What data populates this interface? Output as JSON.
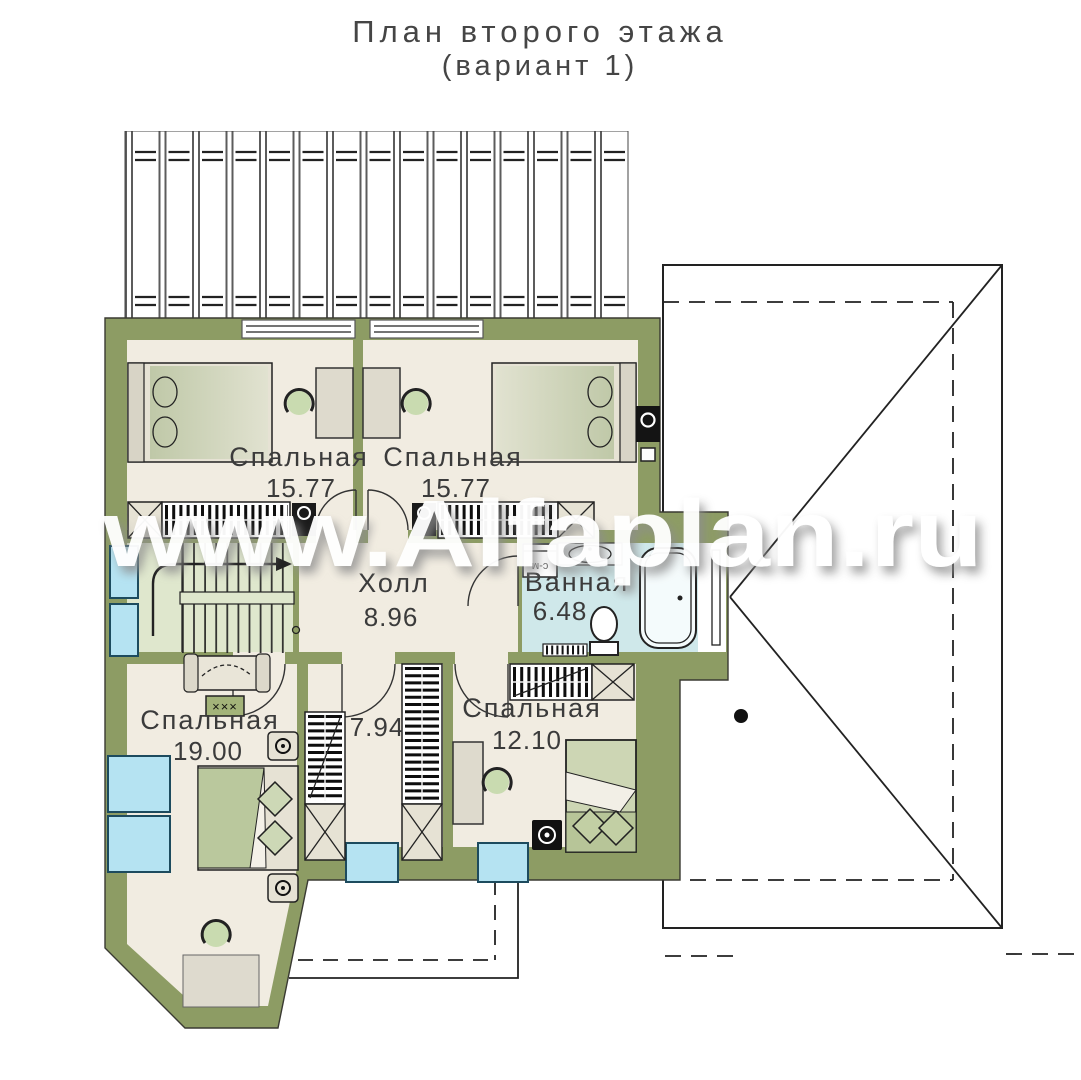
{
  "title": {
    "line1": "План второго этажа",
    "line2": "(вариант 1)"
  },
  "watermark": "www.Alfaplan.ru",
  "rooms": {
    "bedroom_top_left": {
      "name": "Спальная",
      "area": "15.77"
    },
    "bedroom_top_right": {
      "name": "Спальная",
      "area": "15.77"
    },
    "hall": {
      "name": "Холл",
      "area": "8.96"
    },
    "bathroom": {
      "name": "Ванная",
      "area": "6.48"
    },
    "bedroom_bottom_left": {
      "name": "Спальная",
      "area": "19.00"
    },
    "closet": {
      "area": "7.94"
    },
    "bedroom_bottom_right": {
      "name": "Спальная",
      "area": "12.10"
    }
  },
  "annotations": {
    "washing_machine": "с-м",
    "bench": "×××"
  },
  "colors": {
    "wall": "#8d9c64",
    "floor": "#f1ece1",
    "stair_floor": "#dfe7cd",
    "bathroom_floor": "#cfe8ea",
    "window_blue": "#b5e3f2",
    "furniture_beige": "#e6e2d4",
    "bed_green": "#bcc9a0",
    "line": "#222222",
    "title_text": "#454545",
    "watermark_white": "#ffffff"
  }
}
